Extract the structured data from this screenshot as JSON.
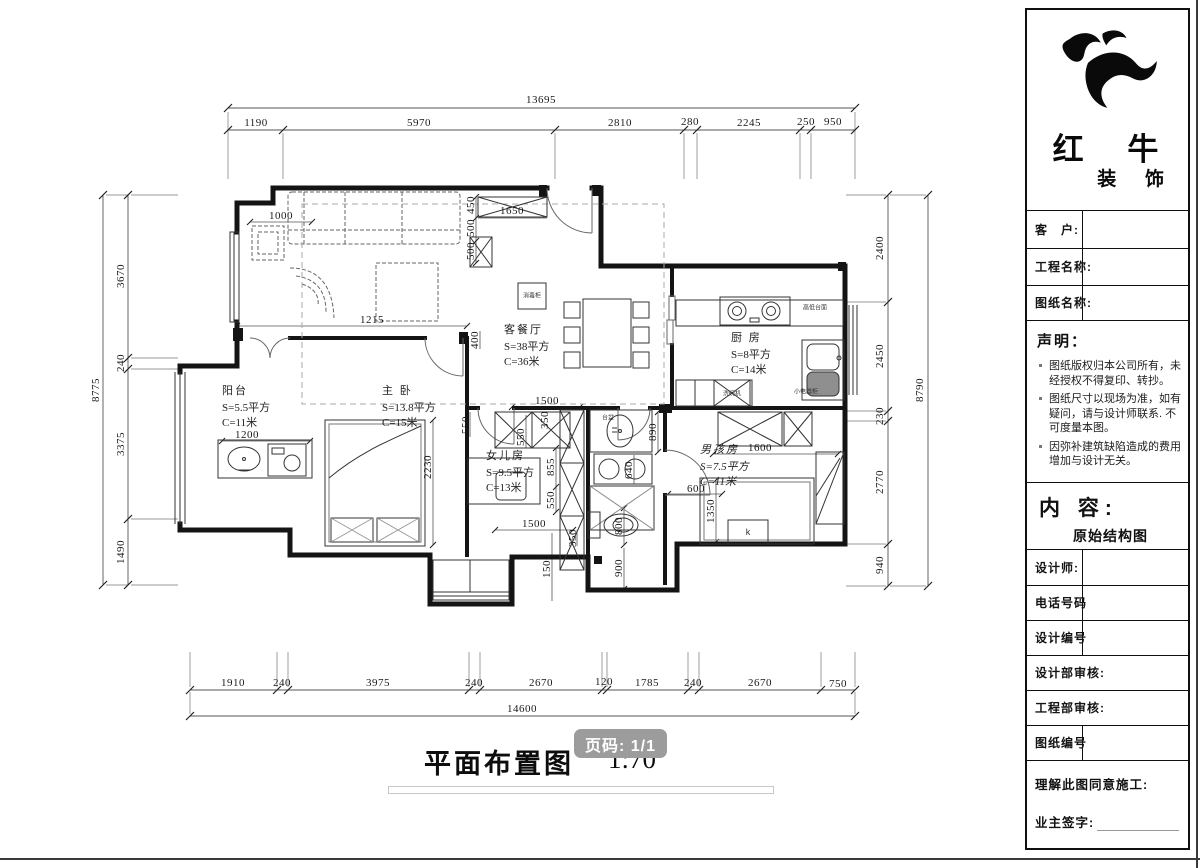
{
  "plan": {
    "title": "平面布置图",
    "scale": "1:70",
    "page_badge": "页码: 1/1",
    "rooms": [
      {
        "name": "客餐厅",
        "area": "S=38平方",
        "len": "C=36米",
        "x": 504,
        "y": 323
      },
      {
        "name": "厨 房",
        "area": "S=8平方",
        "len": "C=14米",
        "x": 731,
        "y": 331
      },
      {
        "name": "阳台",
        "area": "S=5.5平方",
        "len": "C=11米",
        "x": 222,
        "y": 384
      },
      {
        "name": "主 卧",
        "area": "S=13.8平方",
        "len": "C=15米",
        "x": 382,
        "y": 384
      },
      {
        "name": "女儿房",
        "area": "S=9.5平方",
        "len": "C=13米",
        "x": 486,
        "y": 449
      },
      {
        "name": "男孩房",
        "area": "S=7.5平方",
        "len": "C=11米",
        "x": 700,
        "y": 443,
        "it": true
      }
    ],
    "dims": [
      {
        "t": "13695",
        "x": 541,
        "y": 100
      },
      {
        "t": "1190",
        "x": 256,
        "y": 123
      },
      {
        "t": "5970",
        "x": 419,
        "y": 123
      },
      {
        "t": "2810",
        "x": 620,
        "y": 123
      },
      {
        "t": "280",
        "x": 690,
        "y": 122
      },
      {
        "t": "2245",
        "x": 749,
        "y": 123
      },
      {
        "t": "250",
        "x": 806,
        "y": 122
      },
      {
        "t": "950",
        "x": 833,
        "y": 122
      },
      {
        "t": "8775",
        "x": 96,
        "y": 390,
        "r": -90
      },
      {
        "t": "3670",
        "x": 121,
        "y": 276,
        "r": -90
      },
      {
        "t": "240",
        "x": 121,
        "y": 363,
        "r": -90
      },
      {
        "t": "3375",
        "x": 121,
        "y": 444,
        "r": -90
      },
      {
        "t": "1490",
        "x": 121,
        "y": 552,
        "r": -90
      },
      {
        "t": "2400",
        "x": 880,
        "y": 248,
        "r": -90
      },
      {
        "t": "2450",
        "x": 880,
        "y": 356,
        "r": -90
      },
      {
        "t": "230",
        "x": 880,
        "y": 416,
        "r": -90
      },
      {
        "t": "2770",
        "x": 880,
        "y": 482,
        "r": -90
      },
      {
        "t": "940",
        "x": 880,
        "y": 565,
        "r": -90
      },
      {
        "t": "8790",
        "x": 920,
        "y": 390,
        "r": -90
      },
      {
        "t": "1910",
        "x": 233,
        "y": 683
      },
      {
        "t": "240",
        "x": 282,
        "y": 683
      },
      {
        "t": "3975",
        "x": 378,
        "y": 683
      },
      {
        "t": "240",
        "x": 474,
        "y": 683
      },
      {
        "t": "2670",
        "x": 541,
        "y": 683
      },
      {
        "t": "120",
        "x": 604,
        "y": 682
      },
      {
        "t": "1785",
        "x": 647,
        "y": 683
      },
      {
        "t": "240",
        "x": 693,
        "y": 683
      },
      {
        "t": "2670",
        "x": 760,
        "y": 683
      },
      {
        "t": "750",
        "x": 838,
        "y": 684
      },
      {
        "t": "14600",
        "x": 522,
        "y": 709
      },
      {
        "t": "1000",
        "x": 281,
        "y": 216
      },
      {
        "t": "1650",
        "x": 512,
        "y": 211
      },
      {
        "t": "450",
        "x": 471,
        "y": 205,
        "r": -90
      },
      {
        "t": "500",
        "x": 471,
        "y": 228,
        "r": -90
      },
      {
        "t": "500",
        "x": 471,
        "y": 251,
        "r": -90
      },
      {
        "t": "1215",
        "x": 372,
        "y": 320
      },
      {
        "t": "400",
        "x": 475,
        "y": 340,
        "r": -90
      },
      {
        "t": "1500",
        "x": 547,
        "y": 401
      },
      {
        "t": "1200",
        "x": 247,
        "y": 435
      },
      {
        "t": "2230",
        "x": 428,
        "y": 467,
        "r": -90
      },
      {
        "t": "890",
        "x": 653,
        "y": 432,
        "r": -90
      },
      {
        "t": "640",
        "x": 629,
        "y": 470,
        "r": -90
      },
      {
        "t": "800",
        "x": 619,
        "y": 526,
        "r": -90
      },
      {
        "t": "900",
        "x": 619,
        "y": 568,
        "r": -90
      },
      {
        "t": "1600",
        "x": 760,
        "y": 448
      },
      {
        "t": "600",
        "x": 696,
        "y": 489
      },
      {
        "t": "1350",
        "x": 711,
        "y": 511,
        "r": -90
      },
      {
        "t": "855",
        "x": 551,
        "y": 467,
        "r": -90
      },
      {
        "t": "550",
        "x": 551,
        "y": 500,
        "r": -90
      },
      {
        "t": "550",
        "x": 466,
        "y": 425,
        "r": -90
      },
      {
        "t": "350",
        "x": 545,
        "y": 420,
        "r": -90
      },
      {
        "t": "550",
        "x": 521,
        "y": 437,
        "r": -90
      },
      {
        "t": "1500",
        "x": 534,
        "y": 524
      },
      {
        "t": "350",
        "x": 573,
        "y": 538,
        "r": -90
      },
      {
        "t": "1500",
        "x": 547,
        "y": 566,
        "r": -90
      }
    ],
    "annotations": [
      {
        "t": "高低台面",
        "x": 815,
        "y": 307,
        "s": 6
      },
      {
        "t": "小电器柜",
        "x": 806,
        "y": 391,
        "s": 6
      },
      {
        "t": "洗碗机",
        "x": 732,
        "y": 393,
        "s": 6
      },
      {
        "t": "消毒柜",
        "x": 532,
        "y": 295,
        "s": 6
      },
      {
        "t": "台盆",
        "x": 608,
        "y": 417,
        "s": 6
      },
      {
        "t": "k",
        "x": 748,
        "y": 532,
        "s": 9
      }
    ]
  },
  "titleblock": {
    "company": {
      "name": "红 牛",
      "suffix": "装 饰"
    },
    "fields": [
      {
        "label": "客　户:",
        "y": 200,
        "h": 38,
        "divider": true
      },
      {
        "label": "工程名称:",
        "y": 238,
        "h": 37,
        "divider": true
      },
      {
        "label": "图纸名称:",
        "y": 275,
        "h": 35,
        "divider": true
      }
    ],
    "statement": {
      "title": "声明：",
      "items": [
        "图纸版权归本公司所有，未经授权不得复印、转抄。",
        "图纸尺寸以现场为准，如有疑问，请与设计师联系. 不可度量本图。",
        "因弥补建筑缺陷造成的费用增加与设计无关。"
      ]
    },
    "content": {
      "label": "内 容:",
      "value": "原始结构图"
    },
    "rows": [
      {
        "label": "设计师:",
        "y": 539,
        "h": 36,
        "divider": true
      },
      {
        "label": "电话号码",
        "y": 575,
        "h": 35,
        "divider": true
      },
      {
        "label": "设计编号",
        "y": 610,
        "h": 35,
        "divider": true
      },
      {
        "label": "设计部审核:",
        "y": 645,
        "h": 35
      },
      {
        "label": "工程部审核:",
        "y": 680,
        "h": 35
      },
      {
        "label": "图纸编号",
        "y": 715,
        "h": 35,
        "divider": true
      }
    ],
    "footer": {
      "line1": "理解此图同意施工:",
      "line2": "业主签字:"
    }
  }
}
